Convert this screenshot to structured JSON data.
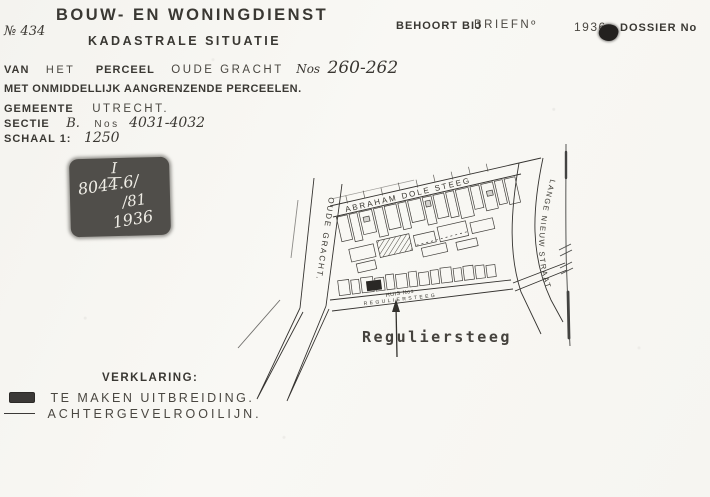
{
  "header": {
    "number": "№ 434",
    "title": "BOUW- EN WONINGDIENST",
    "subtitle": "KADASTRALE SITUATIE",
    "behoort_bij": "BEHOORT BIJ",
    "brief_no": "BRIEFNº",
    "year": "1936",
    "dossier_no": "DOSSIER No"
  },
  "info": {
    "van": "VAN",
    "het": "HET",
    "perceel": "PERCEEL",
    "street": "OUDE GRACHT",
    "nos": "Nos",
    "house_numbers": "260-262",
    "adjacent": "MET ONMIDDELLIJK AANGRENZENDE PERCEELEN.",
    "gemeente": "GEMEENTE",
    "city": "UTRECHT.",
    "sectie": "SECTIE",
    "sectie_letter": "B.",
    "sectie_nos": "Nos",
    "sectie_numbers": "4031-4032",
    "schaal": "SCHAAL 1:",
    "schaal_value": "1250"
  },
  "stamp": {
    "roman": "I",
    "numerator": "8044.6/",
    "denominator": "/81",
    "year": "1936"
  },
  "map": {
    "street_oude_gracht": "OUDE GRACHT.",
    "street_abraham_dole": "ABRAHAM DOLE STEEG",
    "street_lange_nieuw": "LANGE NIEUW STRAAT",
    "street_reguliersteeg_tiny": "REGULIERSTEEG",
    "huis_label": "HUIS Nos",
    "reguliersteeg_label": "Reguliersteeg"
  },
  "legend": {
    "title": "VERKLARING:",
    "item_extension": "TE MAKEN UITBREIDING.",
    "item_rear_line": "ACHTERGEVELROOILIJN."
  },
  "colors": {
    "paper": "#f7f6f2",
    "ink": "#33312d",
    "stamp_fill": "#4f4d49"
  }
}
